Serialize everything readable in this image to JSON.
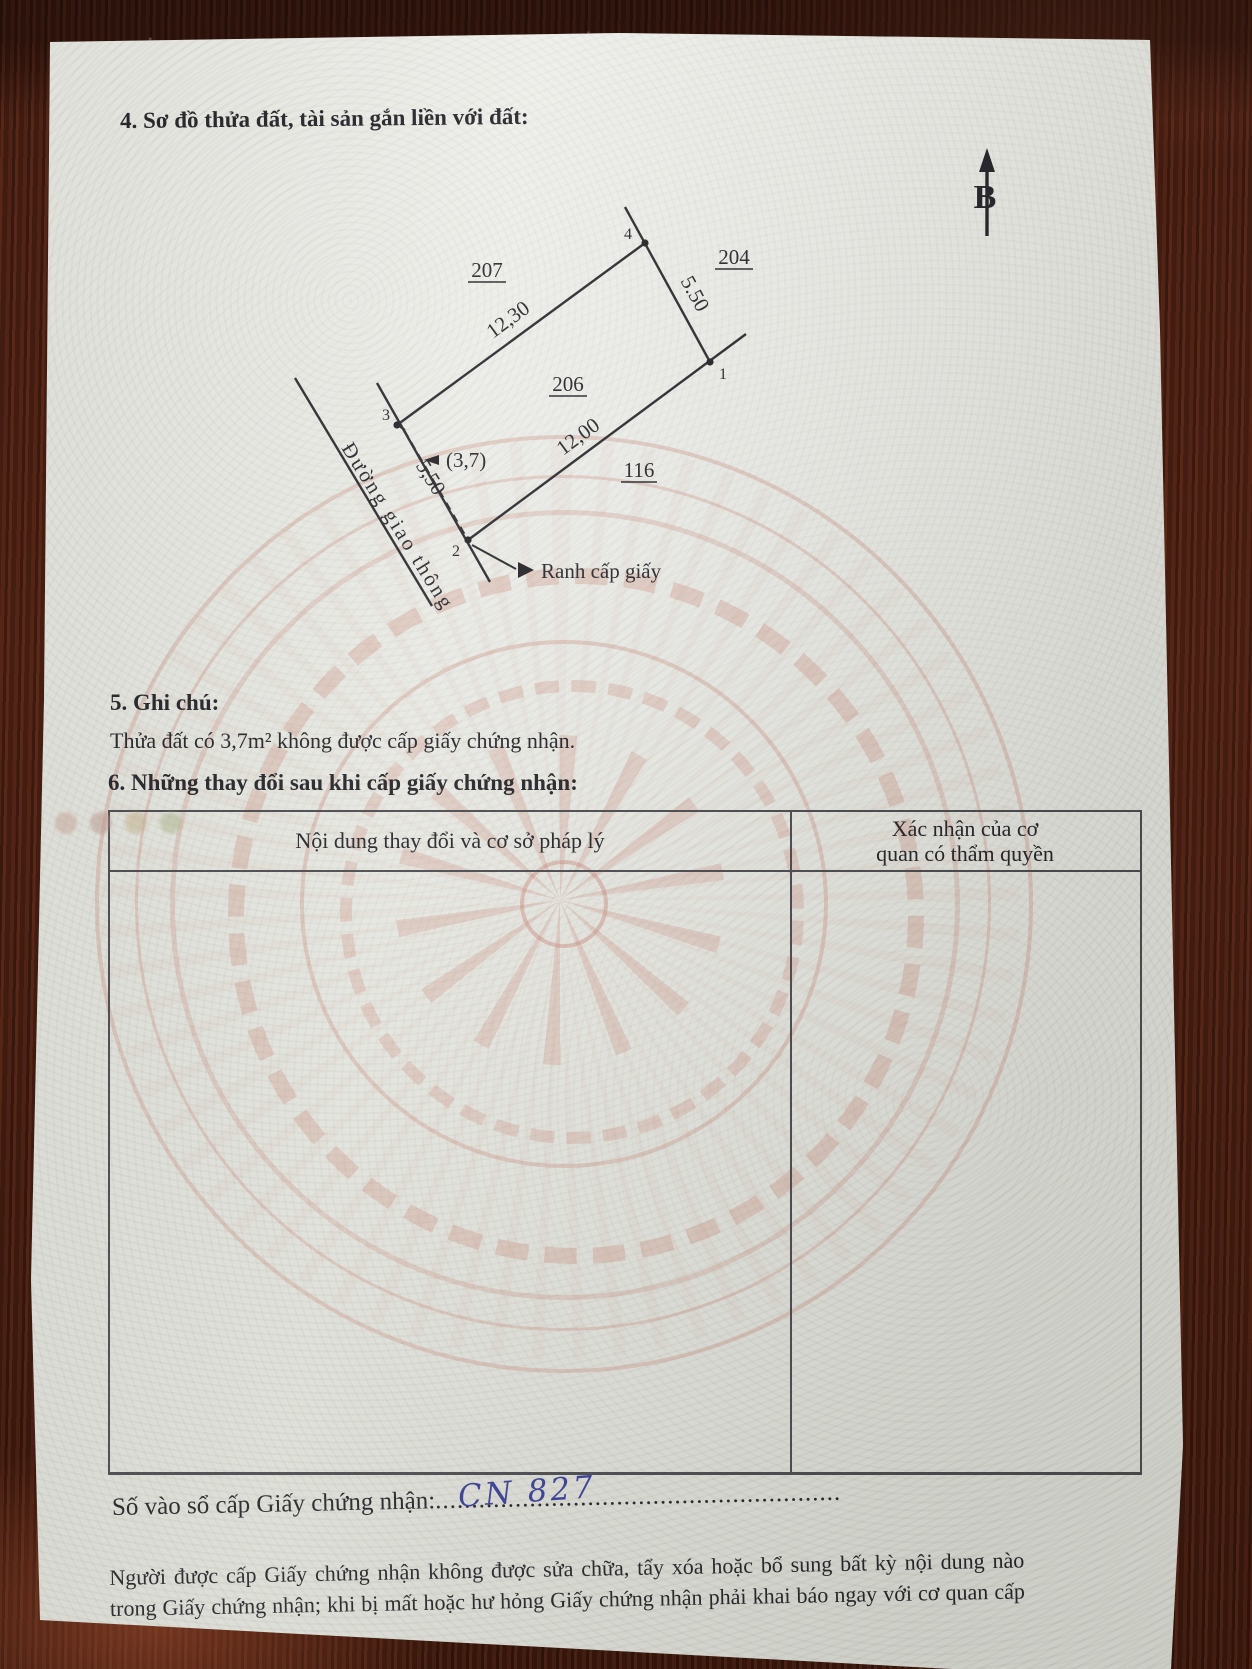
{
  "doc": {
    "section4_title": "4. Sơ đồ thửa đất, tài sản gắn liền với đất:",
    "north_label": "B"
  },
  "diagram": {
    "parcel_207": "207",
    "parcel_204": "204",
    "parcel_206": "206",
    "parcel_116": "116",
    "vertex_1": "1",
    "vertex_2": "2",
    "vertex_3": "3",
    "vertex_4": "4",
    "dim_side_3_4": "12,30",
    "dim_side_4_1": "5.50",
    "dim_side_2_1": "12,00",
    "dim_side_3_2": "5,50",
    "excluded_area": "(3,7)",
    "road_label": "Đường giao thông",
    "boundary_label": "Ranh cấp giấy"
  },
  "section5": {
    "title": "5. Ghi chú:",
    "body": "Thửa đất có 3,7m² không được cấp giấy chứng nhận."
  },
  "section6": {
    "title": "6. Những thay đổi sau khi cấp giấy chứng nhận:",
    "col1_header": "Nội dung thay đổi và cơ sở pháp lý",
    "col2_header_line1": "Xác nhận của cơ",
    "col2_header_line2": "quan có thẩm quyền"
  },
  "registry": {
    "label": "Số vào sổ cấp Giấy chứng nhận:",
    "dots": "........................................................",
    "value": "CN 827"
  },
  "footer": {
    "note_line1": "Người được cấp Giấy chứng nhận không được sửa chữa, tẩy xóa hoặc bổ sung bất kỳ nội dung nào trong",
    "note_line2": "Giấy chứng nhận; khi bị mất hoặc hư hỏng Giấy chứng nhận phải khai báo ngay với cơ quan cấp Giấy."
  }
}
